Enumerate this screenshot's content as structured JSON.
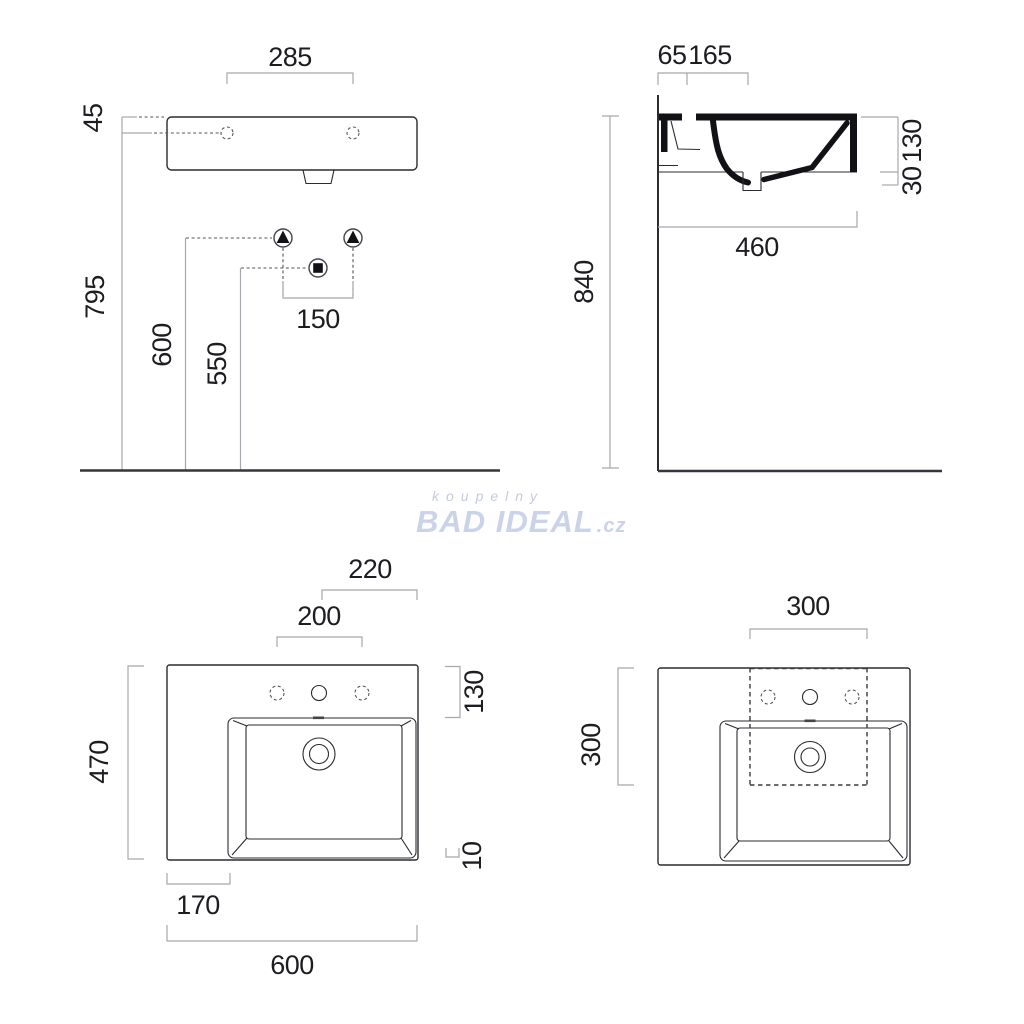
{
  "title": "Washbasin technical dimension drawing",
  "watermark": {
    "line1": "koupelny",
    "brand": "BAD IDEAL",
    "tld": ".cz"
  },
  "dims": {
    "front": {
      "tap_span": "285",
      "rim_offset": "45",
      "rim_height": "795",
      "supply_height": "600",
      "drain_height": "550",
      "supply_span": "150"
    },
    "side": {
      "wall_gap": "65",
      "tap_gap": "165",
      "body_height": "130",
      "lip": "30",
      "depth": "460",
      "height_total": "840"
    },
    "plan": {
      "right_span": "220",
      "hole_span": "200",
      "back_ledge": "130",
      "depth": "470",
      "rim": "10",
      "left_ledge": "170",
      "width": "600"
    },
    "cutout": {
      "width": "300",
      "depth": "300"
    }
  },
  "colors": {
    "line": "#2b2b30",
    "dimension_line": "#a8a8ae",
    "section_fill": "#121216",
    "watermark": "#cbd3e9"
  }
}
